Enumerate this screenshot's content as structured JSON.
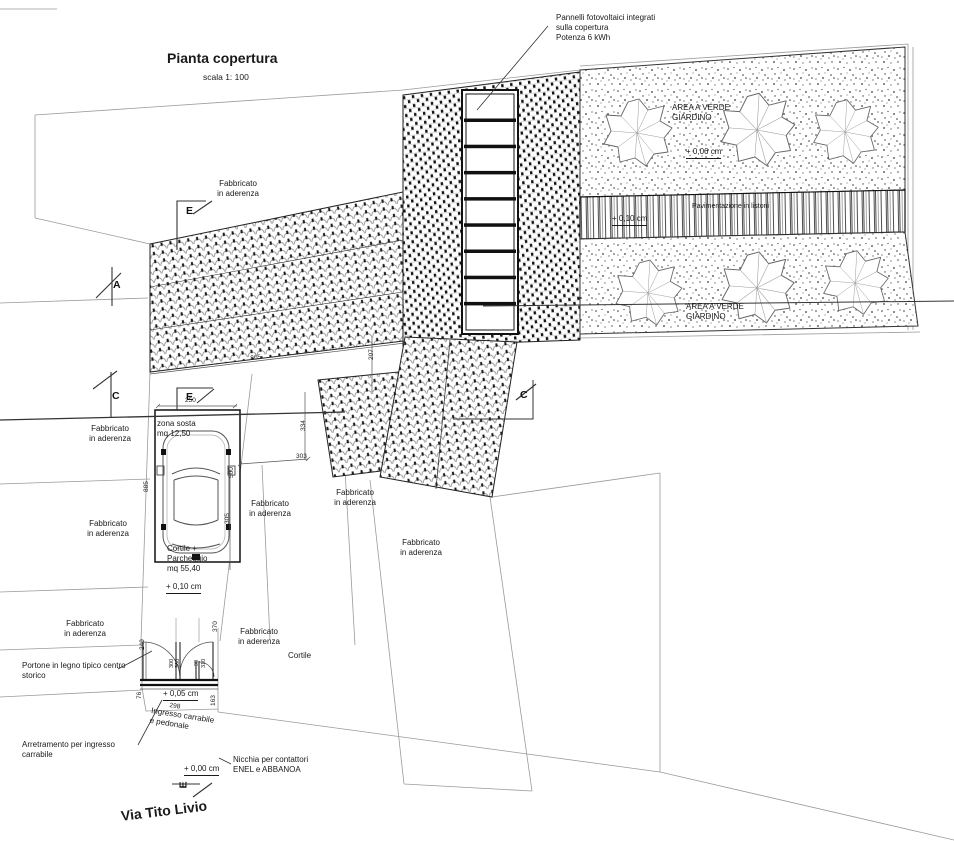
{
  "title": {
    "text": "Pianta copertura",
    "scale": "scala 1: 100"
  },
  "street_name": "Via Tito Livio",
  "labels": {
    "solar_annotation": "Pannelli fotovoltaici integrati\nsulla copertura\nPotenza 6 kWh",
    "area_verde": "AREA A VERDE\nGIARDINO",
    "paving": "Pavimentazione in listoni",
    "fabbricato": "Fabbricato\nin aderenza",
    "zona_sosta": "zona sosta\nmq 12,50",
    "cortile_parcheggio": "Cortile +\nParcheggio\nmq 55,40",
    "cortile": "Cortile",
    "portone": "Portone in legno tipico centro\nstorico",
    "ingresso": "Ingresso carrabile\ne pedonale",
    "arretramento": "Arretramento per ingresso\ncarrabile",
    "nicchia": "Nicchia per contattori\nENEL e ABBANOA"
  },
  "levels": {
    "garden": "+ 0,06 cm",
    "paving": "+ 0,10 cm",
    "courtyard": "+ 0,10 cm",
    "entrance": "+ 0,05 cm",
    "street": "+ 0,00 cm"
  },
  "section_markers": {
    "a": "A",
    "c": "C",
    "e": "E"
  },
  "dims": {
    "roof_width": "865",
    "roof_side": "207",
    "mid_roof_side": "334",
    "court_gap": "303",
    "court_side": "305",
    "parking_width": "250",
    "parking_length": "500",
    "court_length": "885",
    "door_left": "249",
    "door_right": "370",
    "sill": "76",
    "entrance_width": "298",
    "niche_side": "163",
    "leaf_a": "300",
    "leaf_b": "360",
    "small_a": "90",
    "small_b": "310"
  }
}
